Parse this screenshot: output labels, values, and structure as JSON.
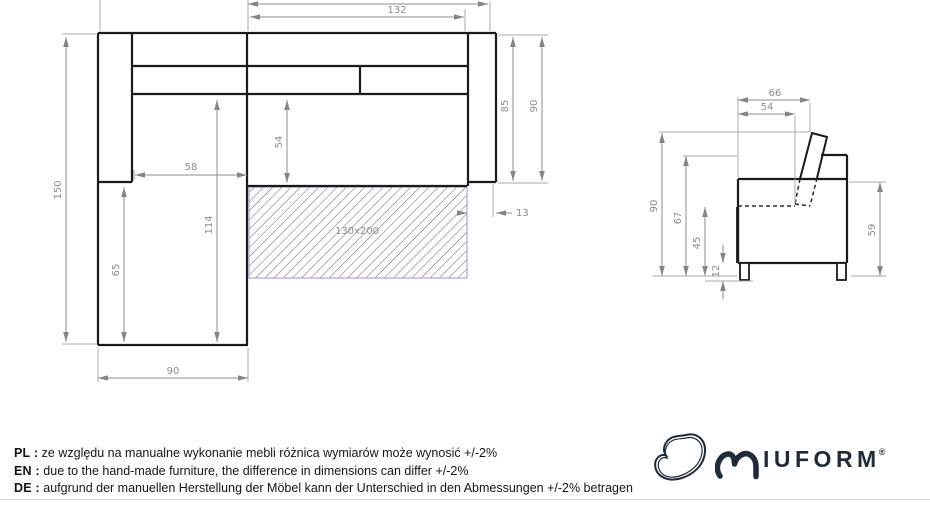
{
  "drawing": {
    "top_view": {
      "bed_area_label": "130x200",
      "dims": {
        "body_width": "132",
        "total_depth": "150",
        "chaise_inner_width": "58",
        "chaise_length": "114",
        "chaise_front_length": "65",
        "seat_depth": "54",
        "armrest_length_inner": "85",
        "armrest_length_outer": "90",
        "chaise_width": "90",
        "armrest_gap": "13"
      }
    },
    "side_view": {
      "dims": {
        "top_depth": "66",
        "backrest_depth": "54",
        "total_height": "90",
        "back_height": "67",
        "seat_height": "45",
        "leg_height": "12",
        "armrest_height": "59"
      }
    }
  },
  "notes": {
    "items": [
      {
        "label": "PL :",
        "text": "ze względu na manualne wykonanie mebli różnica wymiarów może wynosić +/-2%"
      },
      {
        "label": "EN :",
        "text": "due to the hand-made furniture, the difference in dimensions can differ +/-2%"
      },
      {
        "label": "DE :",
        "text": "aufgrund der manuellen Herstellung der Möbel kann der Unterschied in den Abmessungen +/-2% betragen"
      }
    ]
  },
  "logo": {
    "wordmark": "IUFORM",
    "registered": "®"
  },
  "colors": {
    "outline": "#1a1a1a",
    "dimension": "#8c8c8c",
    "bed_border": "#a9a2de",
    "logo": "#1d2b3a"
  }
}
